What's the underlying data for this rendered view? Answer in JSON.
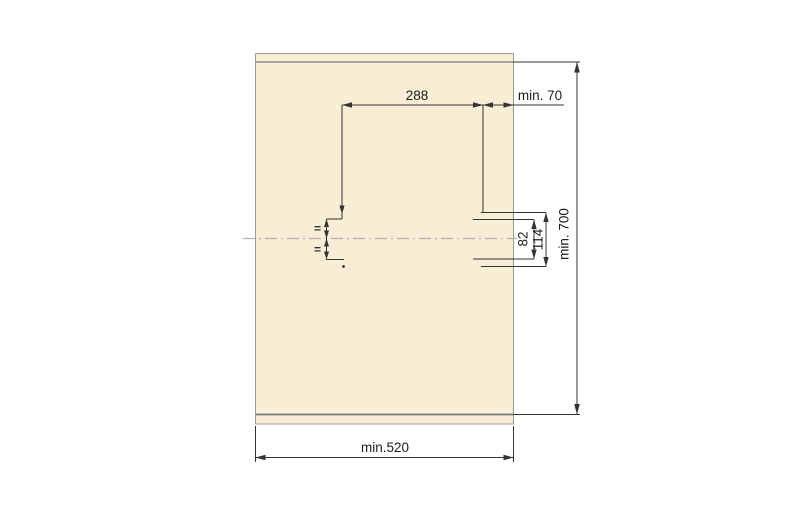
{
  "drawing": {
    "kind": "technical-dimension-drawing",
    "subject": "front-panel-drilling-template",
    "labels": {
      "width_top": "288",
      "offset_top_right": "min. 70",
      "hole_pitch_inner": "82",
      "hole_pitch_outer": "114",
      "height_right": "min. 700",
      "width_bottom": "min.520",
      "equal_mark_upper": "=",
      "equal_mark_lower": "="
    },
    "colors": {
      "bg": "#ffffff",
      "panel_fill": "#f8eed6",
      "panel_border": "#9a9a9a",
      "strip_line": "#7a7a7a",
      "dim_line": "#333333",
      "centerline": "#b2b0ab",
      "text": "#1d1d1d"
    }
  }
}
